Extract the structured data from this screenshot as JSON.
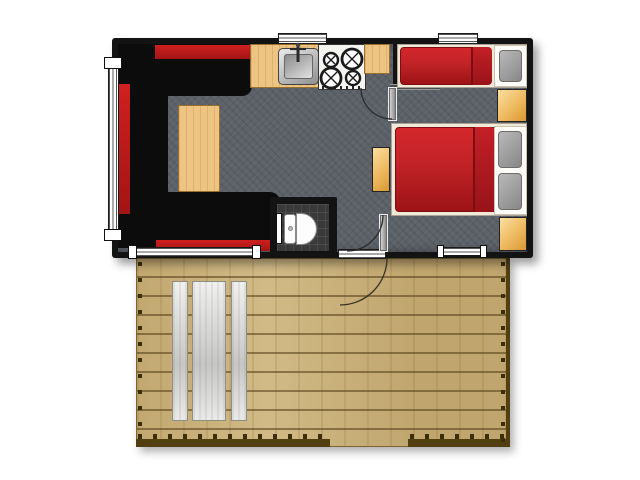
{
  "meta": {
    "description": "Top-down floor plan of a small mobile home / holiday caravan with attached wooden terrace deck",
    "canvas": {
      "width": 640,
      "height": 480
    }
  },
  "colors": {
    "wall": "#131313",
    "floor": "#5d6268",
    "sofa_base": "#0c0c0c",
    "sofa_red": "#cf2020",
    "wood": "#eec482",
    "bed_red": "#c32428",
    "bed_frame": "#f0e9d8",
    "pillow": "#a0a0a0",
    "cabinet": "#eeb95f",
    "stove": "#f4f4f1",
    "tile": "#3a3a3a",
    "toilet": "#fdfdfd",
    "window": "#ffffff",
    "deck": "#cbb27c",
    "rail": "#513f12",
    "post": "#3c2e08",
    "picnic": "#e0e0de",
    "arc": "#2b2b2b"
  },
  "rooms": [
    {
      "name": "living-area"
    },
    {
      "name": "kitchen"
    },
    {
      "name": "bathroom"
    },
    {
      "name": "bedroom-single"
    },
    {
      "name": "bedroom-double"
    },
    {
      "name": "hallway"
    },
    {
      "name": "terrace-deck"
    }
  ],
  "furniture": [
    {
      "name": "corner-sofa",
      "room": "living-area",
      "style": "black with red accents"
    },
    {
      "name": "coffee-table",
      "room": "living-area",
      "material": "wood"
    },
    {
      "name": "kitchen-sink",
      "room": "kitchen"
    },
    {
      "name": "stove-4-burners",
      "room": "kitchen"
    },
    {
      "name": "kitchen-counter",
      "room": "kitchen",
      "material": "wood"
    },
    {
      "name": "toilet",
      "room": "bathroom"
    },
    {
      "name": "single-bed",
      "room": "bedroom-single",
      "bedding": "red",
      "pillows": 1
    },
    {
      "name": "double-bed",
      "room": "bedroom-double",
      "bedding": "red",
      "pillows": 2
    },
    {
      "name": "wardrobe-cabinet",
      "count": 2,
      "material": "wood"
    },
    {
      "name": "nightstand",
      "room": "hallway",
      "material": "wood"
    },
    {
      "name": "picnic-table-with-benches",
      "room": "terrace-deck"
    }
  ],
  "openings": [
    {
      "name": "window-left-wall"
    },
    {
      "name": "window-above-sink"
    },
    {
      "name": "window-above-single-bed"
    },
    {
      "name": "window-bottom-living"
    },
    {
      "name": "window-bottom-bedroom"
    },
    {
      "name": "entrance-door",
      "swing": "onto deck"
    },
    {
      "name": "interior-door-hall",
      "swing": "into hallway"
    },
    {
      "name": "interior-door-bedroom",
      "swing": "into corridor"
    }
  ]
}
